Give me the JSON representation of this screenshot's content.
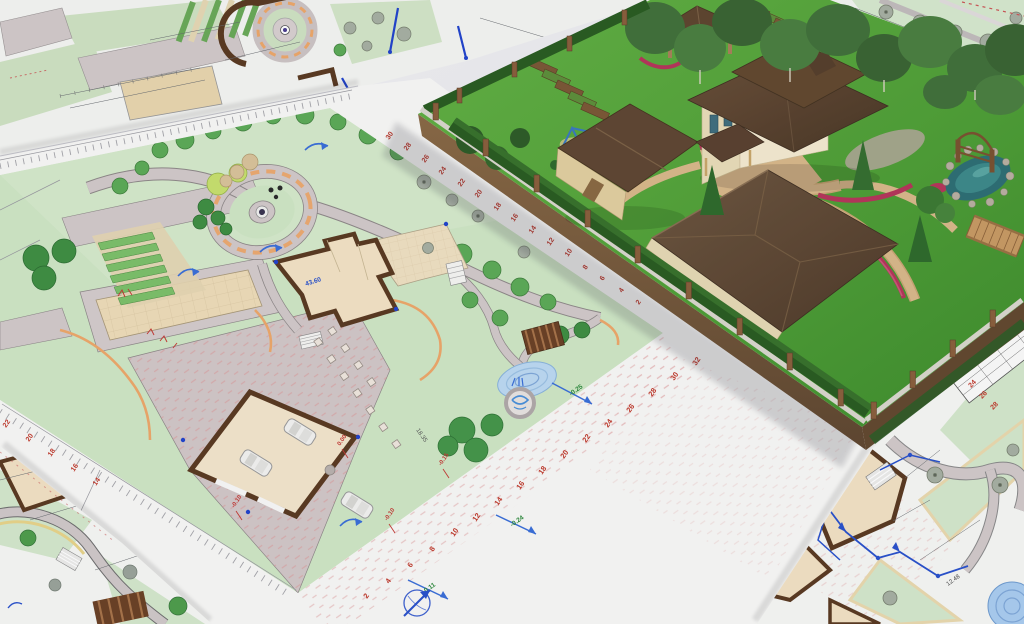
{
  "central_plan": {
    "ruler_bottom": [
      "2",
      "4",
      "6",
      "8",
      "10",
      "12",
      "14",
      "16",
      "18",
      "20",
      "22",
      "24",
      "26",
      "28",
      "30",
      "32"
    ],
    "ruler_top_right": [
      "2",
      "4",
      "6",
      "8",
      "10",
      "12",
      "14",
      "16",
      "18",
      "20",
      "22",
      "24",
      "26",
      "28",
      "30"
    ],
    "ruler_left": [
      "14",
      "16",
      "18",
      "20",
      "22"
    ],
    "slope_labels": [
      "-0.25",
      "-0.24",
      "-0.11"
    ],
    "elevation_marks": [
      "0.00",
      "-0.10",
      "-0.10",
      "-0.15"
    ],
    "level_label": "43.60",
    "dimension_label": "18.35"
  },
  "side_plan": {
    "ruler_numbers": [
      "20",
      "22",
      "24",
      "26",
      "28"
    ],
    "dimension_label": "12.48"
  },
  "icons": {
    "north_arrow": "compass arrow"
  },
  "colors": {
    "lawn_plan": "#cfe7c5",
    "lawn_3d": "#55a73c",
    "paving": "#d2c9c9",
    "sand_tan": "#eedcb8",
    "wall_brown": "#5a3a22",
    "roof_brown": "#5e4431",
    "water_blue": "#aed0ee",
    "annotation_red": "#c43a35",
    "annotation_blue": "#2a52cc",
    "annotation_green": "#2e8b3d",
    "flower_red": "#b5365a",
    "earth_brown": "#7a5a3a"
  }
}
